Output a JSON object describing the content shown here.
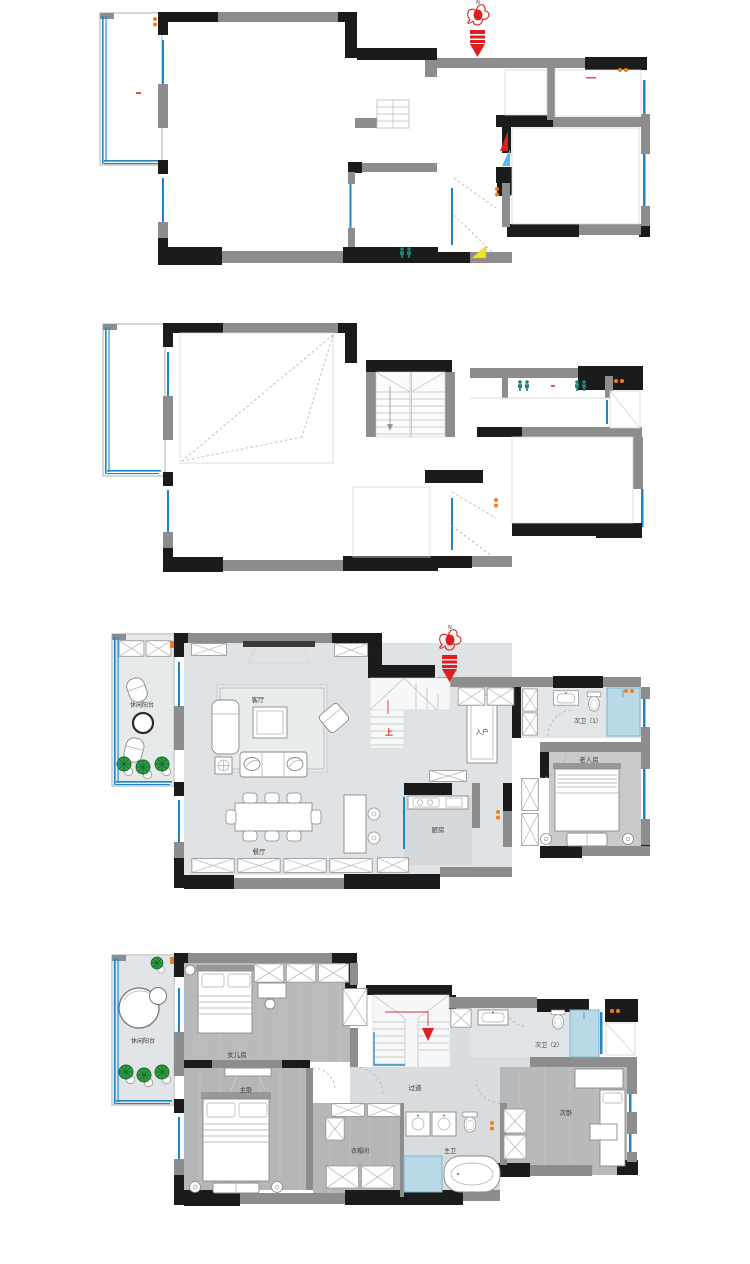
{
  "compass": {
    "north_label": "N"
  },
  "colors": {
    "wall_black": "#1b1b1b",
    "wall_gray": "#8d8d8d",
    "window_blue": "#1d86c8",
    "accent_red": "#dd1f1f",
    "orange": "#f07d1a",
    "teal": "#1e837a",
    "yellow": "#f0e42a",
    "plant_green": "#2f9e44",
    "shower_blue": "#bad9e6",
    "marble_floor": "#e0e3e5",
    "wood_floor": "#b5b7b9"
  },
  "icons": {
    "north": "north-compass-rooster-arrow",
    "entry": "entry-arrow",
    "people": "person-marker",
    "plant": "potted-plant"
  },
  "plans": [
    {
      "name": "floor-plan-structural-upper",
      "labels": {}
    },
    {
      "name": "floor-plan-structural-lower",
      "labels": {}
    },
    {
      "name": "floor-plan-level1-furnished",
      "labels": {
        "balcony": "休闲阳台",
        "living": "客厅",
        "dining": "餐厅",
        "kitchen": "厨房",
        "entry": "入户",
        "up": "上",
        "bath1": "次卫（1）",
        "elder": "老人房"
      }
    },
    {
      "name": "floor-plan-level2-furnished",
      "labels": {
        "balcony": "休闲阳台",
        "daughter": "女儿房",
        "master": "主卧",
        "corridor": "过道",
        "cloak": "衣帽间",
        "masterbath": "主卫",
        "bath2": "次卫（2）",
        "second": "次卧"
      }
    }
  ]
}
